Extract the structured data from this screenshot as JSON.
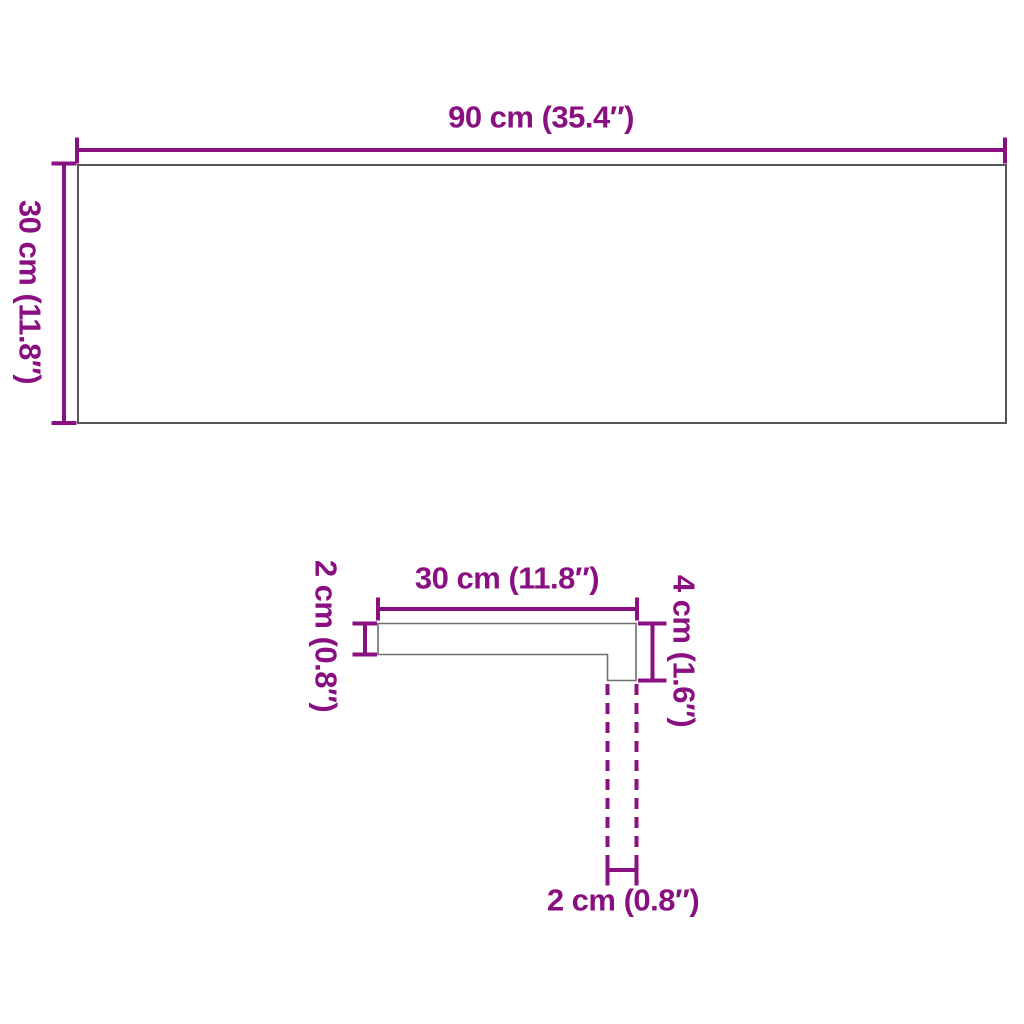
{
  "colors": {
    "accent": "#8a0f80",
    "outline": "#565656",
    "profile_outline": "#6f6f6f",
    "background": "#ffffff"
  },
  "top_view": {
    "width_label": "90 cm (35.4″)",
    "height_label": "30 cm (11.8″)"
  },
  "profile_view": {
    "width_label": "30 cm (11.8″)",
    "thickness_label": "2 cm (0.8″)",
    "height_label": "4 cm (1.6″)",
    "nose_label": "2 cm (0.8″)"
  }
}
